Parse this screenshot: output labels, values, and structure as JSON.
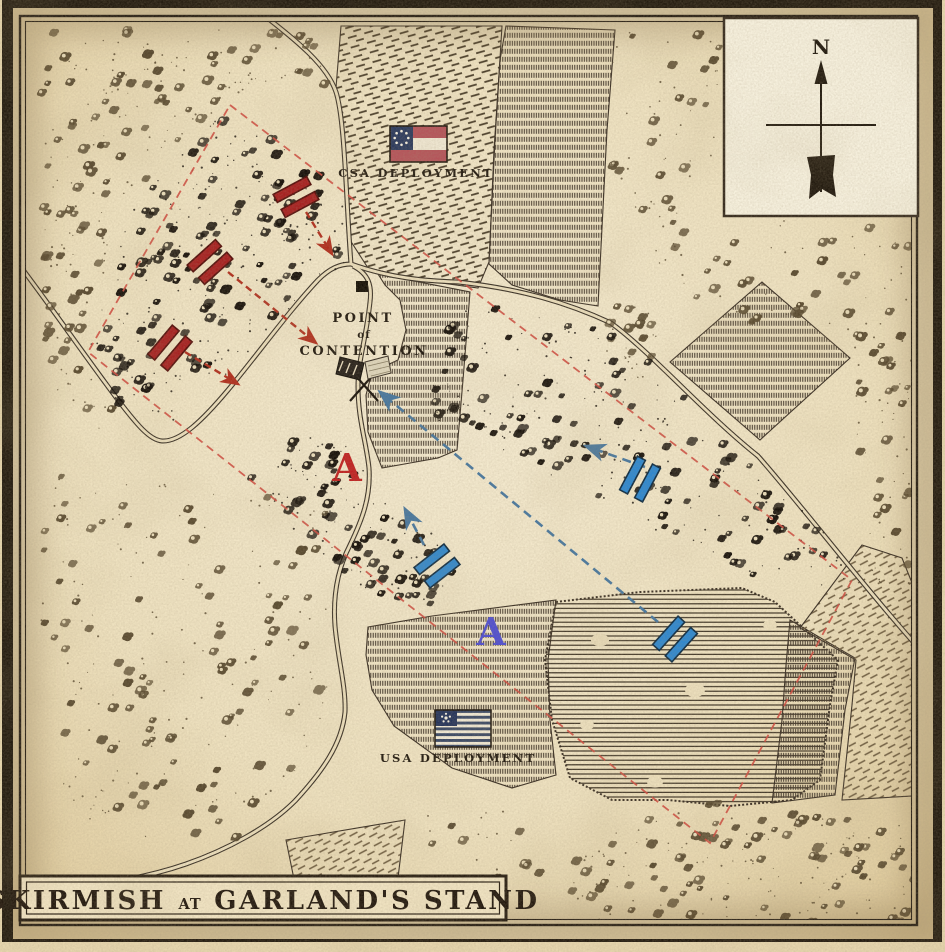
{
  "title": {
    "text": "SKIRMISH AT GARLAND'S STAND",
    "word1": "SKIRMISH",
    "connector": "AT",
    "word2": "GARLAND'S STAND"
  },
  "compass": {
    "label": "N"
  },
  "deployments": {
    "csa": {
      "label": "CSA DEPLOYMENT"
    },
    "usa": {
      "label": "USA DEPLOYMENT"
    }
  },
  "point_of_contention": {
    "line1": "POINT",
    "line2": "of",
    "line3": "CONTENTION"
  },
  "objective_markers": {
    "csa": {
      "letter": "A",
      "x": 347,
      "y": 481,
      "color": "#c02323"
    },
    "usa": {
      "letter": "A",
      "x": 491,
      "y": 645,
      "color": "#5150cf"
    }
  },
  "colors": {
    "csa_unit": "#a62121",
    "csa_unit_stroke": "#55100c",
    "usa_unit": "#2f88cf",
    "usa_unit_stroke": "#0e2c44",
    "csa_arrow": "#b1301f",
    "usa_arrow": "#49789f",
    "boundary": "#cf4f42",
    "ink": "#241c12",
    "paper": "#ecdfbd"
  },
  "units": {
    "echelon": "II",
    "csa": [
      {
        "x": 296,
        "y": 197,
        "angle": -28
      },
      {
        "x": 210,
        "y": 262,
        "angle": -42
      },
      {
        "x": 170,
        "y": 348,
        "angle": -50
      }
    ],
    "usa": [
      {
        "x": 640,
        "y": 479,
        "angle": -62
      },
      {
        "x": 437,
        "y": 566,
        "angle": -38
      },
      {
        "x": 675,
        "y": 639,
        "angle": -48
      }
    ]
  },
  "arrows": {
    "csa": [
      {
        "x1": 306,
        "y1": 212,
        "x2": 332,
        "y2": 254
      },
      {
        "x1": 228,
        "y1": 272,
        "x2": 316,
        "y2": 343
      },
      {
        "x1": 185,
        "y1": 352,
        "x2": 238,
        "y2": 384
      }
    ],
    "usa": [
      {
        "x1": 645,
        "y1": 467,
        "x2": 586,
        "y2": 446
      },
      {
        "x1": 424,
        "y1": 545,
        "x2": 405,
        "y2": 509
      },
      {
        "x1": 658,
        "y1": 622,
        "x2": 380,
        "y2": 392
      }
    ]
  },
  "boundary": {
    "style": "dashed",
    "corners": [
      [
        230,
        105
      ],
      [
        852,
        580
      ],
      [
        710,
        843
      ],
      [
        88,
        352
      ]
    ]
  },
  "structures": [
    {
      "type": "building",
      "x": 356,
      "y": 281
    }
  ]
}
